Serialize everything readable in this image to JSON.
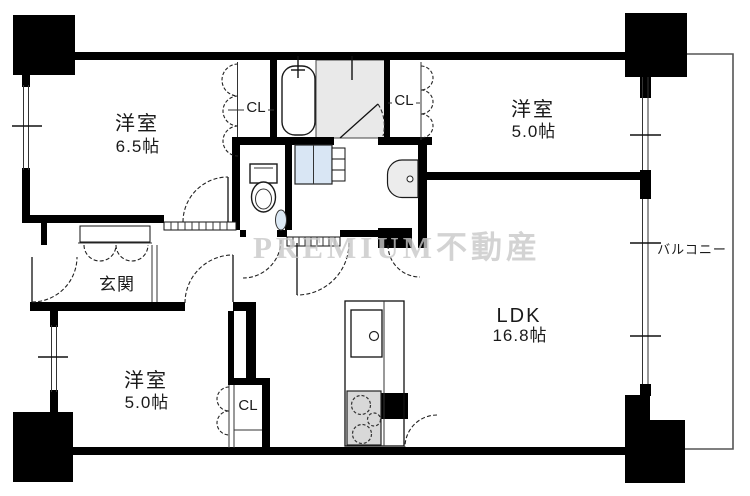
{
  "floorplan": {
    "watermark": "PREMIUM不動産",
    "rooms": {
      "bedroom_top_left": {
        "name": "洋室",
        "size": "6.5帖"
      },
      "bedroom_top_right": {
        "name": "洋室",
        "size": "5.0帖"
      },
      "bedroom_bottom_left": {
        "name": "洋室",
        "size": "5.0帖"
      },
      "ldk": {
        "name": "LDK",
        "size": "16.8帖"
      },
      "entrance": {
        "name": "玄関"
      },
      "balcony": {
        "name": "バルコニー"
      },
      "closet_top_left": {
        "name": "CL"
      },
      "closet_top_right": {
        "name": "CL"
      },
      "closet_bottom": {
        "name": "CL"
      }
    },
    "fixtures": [
      "bathtub",
      "shower-room",
      "toilet",
      "corner-basin",
      "washer-pan",
      "washbasin",
      "kitchen-sink",
      "stove"
    ],
    "colors": {
      "background": "#ffffff",
      "wall": "#000000",
      "bath_floor": "#e9e9e9",
      "washer_pan": "#d9e6f4",
      "stove": "#d8d8d8",
      "watermark": "#c9c9c9"
    }
  }
}
